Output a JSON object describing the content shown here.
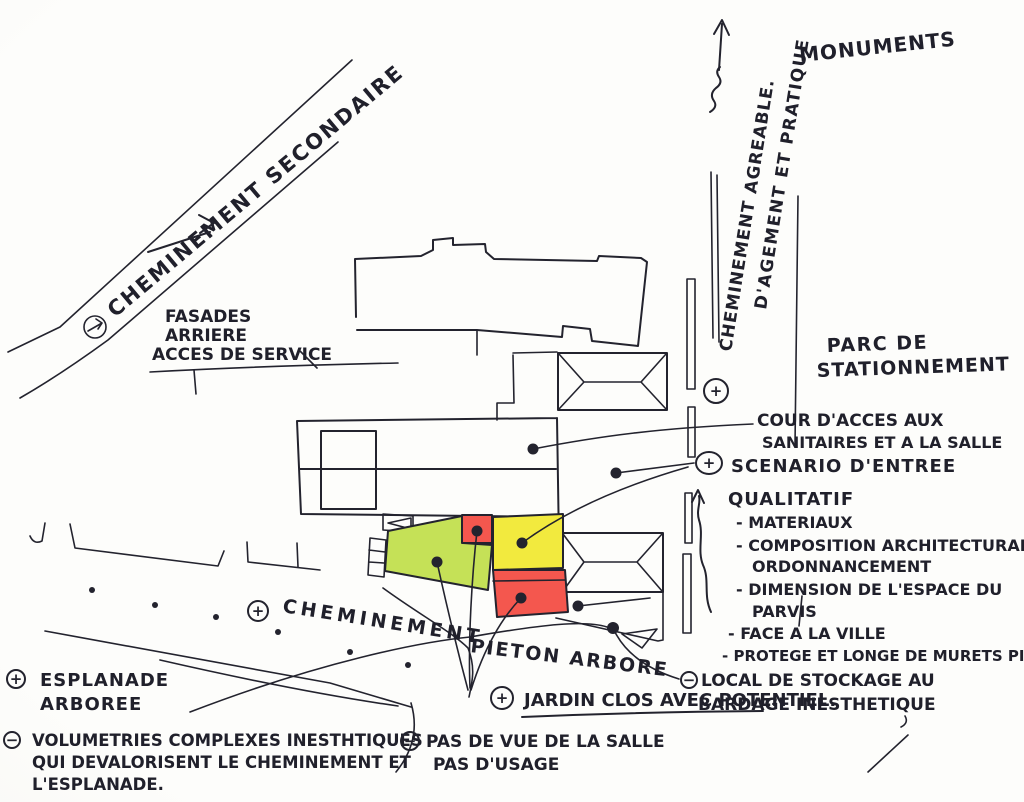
{
  "palette": {
    "ink": "#23232e",
    "paper": "#fcfcfa"
  },
  "zones": {
    "green": "#c5e157",
    "yellow": "#f2ea3e",
    "red": "#f4574e"
  },
  "signs": {
    "plus": "+",
    "minus": "−"
  },
  "roads": {
    "secondary": "CHEMINEMENT SECONDAIRE",
    "north_1": "CHEMINEMENT AGREABLE.",
    "north_2": "D'AGEMENT ET PRATIQUE",
    "monuments": "MONUMENTS"
  },
  "annotations": {
    "facades": [
      "FASADES",
      "ARRIERE",
      "ACCES DE SERVICE"
    ],
    "parking": [
      "PARC DE",
      "STATIONNEMENT"
    ],
    "cour": [
      "COUR D'ACCES AUX",
      "SANITAIRES ET A LA SALLE"
    ],
    "scenario": "SCENARIO D'ENTREE",
    "qualitatif_title": "QUALITATIF",
    "qualitatif_items": [
      "- MATERIAUX",
      "- COMPOSITION ARCHITECTURAL",
      "ORDONNANCEMENT",
      "- DIMENSION DE L'ESPACE DU",
      "PARVIS",
      "- FACE A LA VILLE",
      "- PROTEGE ET LONGE DE MURETS PIERRE"
    ],
    "cheminement": "CHEMINEMENT",
    "pieton": "PIETON ARBORE",
    "esplanade": [
      "ESPLANADE",
      "ARBOREE"
    ],
    "volumetries": [
      "VOLUMETRIES COMPLEXES INESTHTIQUES",
      "QUI DEVALORISENT LE CHEMINEMENT ET",
      "L'ESPLANADE."
    ],
    "jardin": "JARDIN CLOS AVEC POTENTIEL.",
    "pas_de_vue": [
      "PAS DE VUE DE LA SALLE",
      "PAS D'USAGE"
    ],
    "local": [
      "LOCAL DE STOCKAGE AU",
      "BARDAGE INESTHETIQUE"
    ]
  }
}
